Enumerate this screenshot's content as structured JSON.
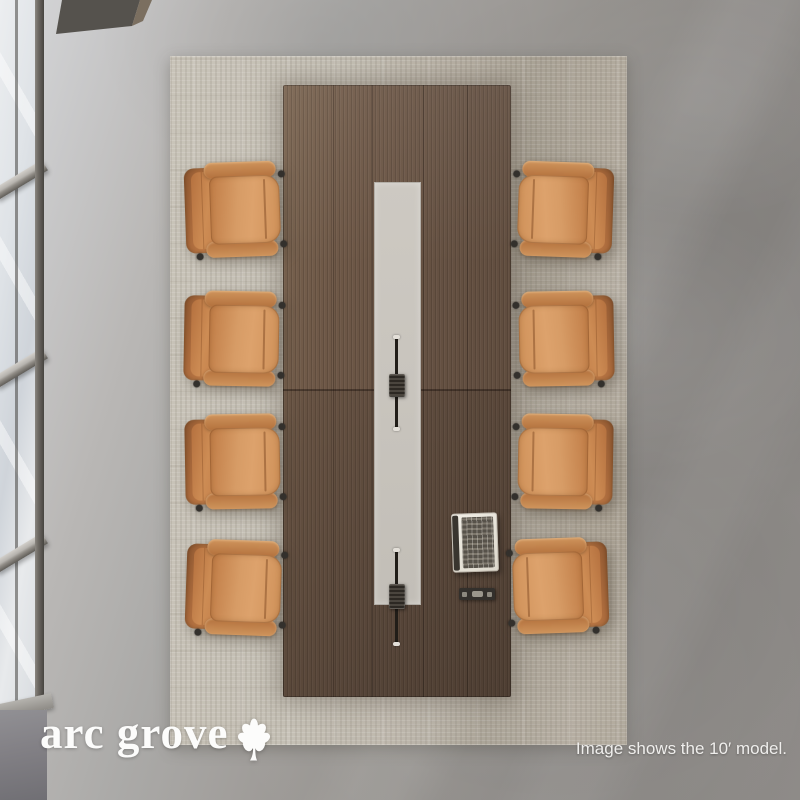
{
  "page": {
    "type": "product-photo",
    "width": 800,
    "height": 800
  },
  "brand": {
    "name": "arc grove",
    "icon": "leaf"
  },
  "caption": {
    "text": "Image shows the 10′ model."
  },
  "scene": {
    "view": "top-down",
    "room": {
      "floor": "concrete",
      "window_side": "left"
    },
    "rug": {
      "style": "distressed woven"
    },
    "table": {
      "shape": "rectangular",
      "finish": "walnut",
      "length_label": "10′",
      "accessories": [
        "cable-slot",
        "power-module",
        "cable-slot",
        "power-module",
        "conference-console",
        "power-outlet-strip"
      ]
    },
    "chairs": {
      "count": 8,
      "per_side": 4,
      "items": [
        {
          "side": "left",
          "x": 185,
          "y": 162,
          "rot": -2
        },
        {
          "side": "left",
          "x": 184,
          "y": 291,
          "rot": 1
        },
        {
          "side": "left",
          "x": 185,
          "y": 414,
          "rot": -1
        },
        {
          "side": "left",
          "x": 186,
          "y": 540,
          "rot": 2
        },
        {
          "side": "right",
          "x": 513,
          "y": 162,
          "rot": 2
        },
        {
          "side": "right",
          "x": 514,
          "y": 291,
          "rot": -1
        },
        {
          "side": "right",
          "x": 513,
          "y": 414,
          "rot": 1
        },
        {
          "side": "right",
          "x": 508,
          "y": 538,
          "rot": -2
        }
      ]
    }
  },
  "palette": {
    "wood": "#6a5444",
    "channel": "#c9c5be",
    "leather": "#c9854f",
    "rug": "#bdb6aa",
    "floor": "#a09d9a",
    "logo_text": "#fcfcfb",
    "caption_text": "#efeeec"
  }
}
